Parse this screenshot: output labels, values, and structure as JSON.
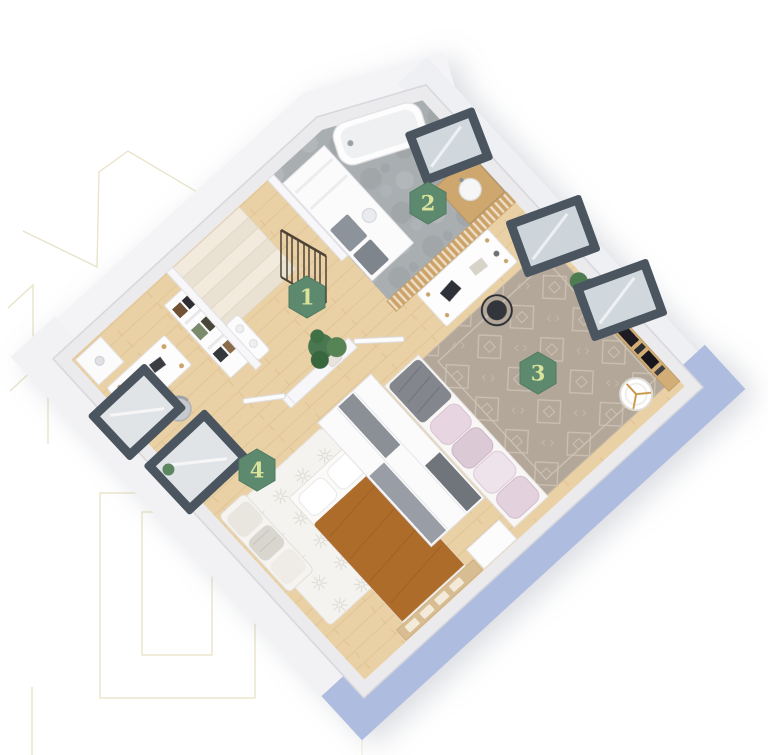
{
  "floor_plan": {
    "badges": [
      {
        "label": "1"
      },
      {
        "label": "2"
      },
      {
        "label": "3"
      },
      {
        "label": "4"
      }
    ]
  },
  "palette": {
    "badge_green": "#5d8a6e",
    "badge_number": "#d9e39c",
    "decor_gold": "#e8e1c3",
    "outer_wall_blue": "#aebcdf",
    "wall_fill": "#ebebee",
    "wood_floor": "#ead1a5",
    "bathroom_floor": "#a9aeb1",
    "living_rug": "#b3a79a",
    "bedroom_rug": "#f4f3f0",
    "window_frame": "#4a5560",
    "bed_blanket": "#ae6c2c"
  }
}
